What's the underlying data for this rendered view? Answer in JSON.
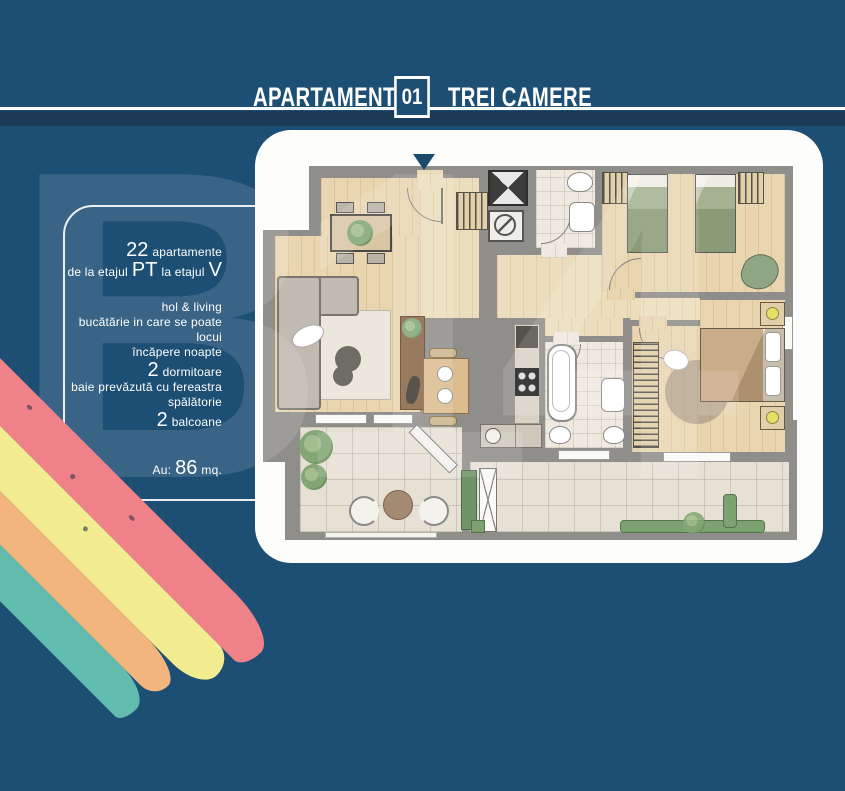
{
  "header": {
    "title": "APARTAMENT",
    "number": "01",
    "subtitle": "TREI CAMERE"
  },
  "info": {
    "line1_num": "22",
    "line1_text": "apartamente",
    "line2_a": "de la etajul",
    "line2_b": "PT",
    "line2_c": "la etajul",
    "line2_d": "V",
    "features": [
      "hol & living",
      "bucătărie in care se poate locui",
      "încăpere noapte"
    ],
    "bedrooms_num": "2",
    "bedrooms_text": "dormitoare",
    "features2": [
      "baie prevăzută cu fereastra",
      "spălătorie"
    ],
    "balconies_num": "2",
    "balconies_text": "balcoane",
    "area_label": "Au:",
    "area_value": "86",
    "area_unit": "mq."
  },
  "watermark": "B14",
  "colors": {
    "background": "#1d4e73",
    "header_band": "#1a3a55",
    "card": "#fdfdfb",
    "wall": "#908e8a",
    "wood_floor": "#e9d6b1",
    "bed_green": "#94a383",
    "bed_tan": "#c9ac88",
    "rainbow_pink": "#ef8289",
    "rainbow_yellow": "#f2ec90",
    "rainbow_orange": "#f2b57e",
    "rainbow_teal": "#62bcae",
    "lamp_yellow": "#e6df63"
  }
}
